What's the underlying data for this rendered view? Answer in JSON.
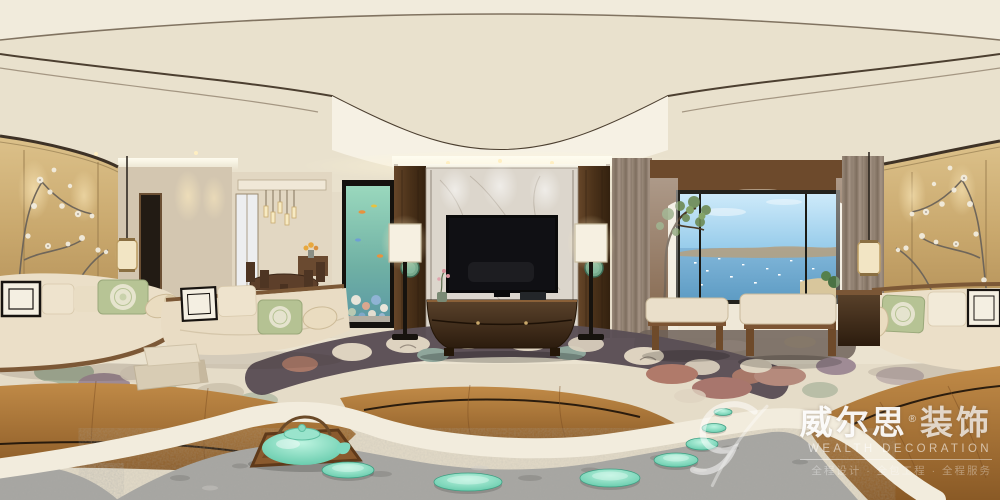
{
  "watermark": {
    "brand_cn": "威尔思",
    "registered": "®",
    "brand_cn_suffix": "装饰",
    "brand_en": "WEALTH DECORATION",
    "tagline": "全程设计 · 全包工程 · 全程服务"
  },
  "scene": {
    "type": "equirectangular-360-panorama-photo",
    "subject": "new Chinese style living room with marble TV wall and sea-view bay window",
    "palette": {
      "ceiling_cream": "#ece4d1",
      "wall_gold": "#c9a86d",
      "dark_walnut": "#4a3423",
      "wood_platform": "#a96f33",
      "marble": "#dcd6cc",
      "sofa_cream": "#e9dcc4",
      "pillow_green": "#b5c293",
      "carpet_cream": "#e5dcc8",
      "carpet_cloud_dark": "#5a4e55",
      "slate_grey": "#a6a5a1",
      "celadon_teal": "#7fd9c0",
      "sky_blue": "#9fd0ec",
      "sea_blue": "#6fa8cc"
    },
    "objects": [
      "scalloped coffered ceiling with cove lighting",
      "gold plum-blossom wall panels (left and right)",
      "hanging fabric lanterns",
      "corridor with dark framed mirror",
      "distant dining nook with pendant light cluster and round table",
      "vertical aquarium column with corals and fish",
      "marble TV wall flanked by walnut pillars with jade discs",
      "flat-screen TV and curved walnut media cabinet",
      "twin floor lamps with white shades",
      "sea-view bay window with boats and headland",
      "indoor tree and white planter",
      "two wooden benches with cream cushions",
      "cloud-pattern carpet (cream, sage, mauve, rust, charcoal)",
      "curved wooden tea-platform ring with black inlay line",
      "grey slate path with celadon stepping discs",
      "wooden tray with celadon teapot and rope handle",
      "curved cream daybed and sofas with medallion pillows",
      "stacked floor cushions"
    ]
  }
}
